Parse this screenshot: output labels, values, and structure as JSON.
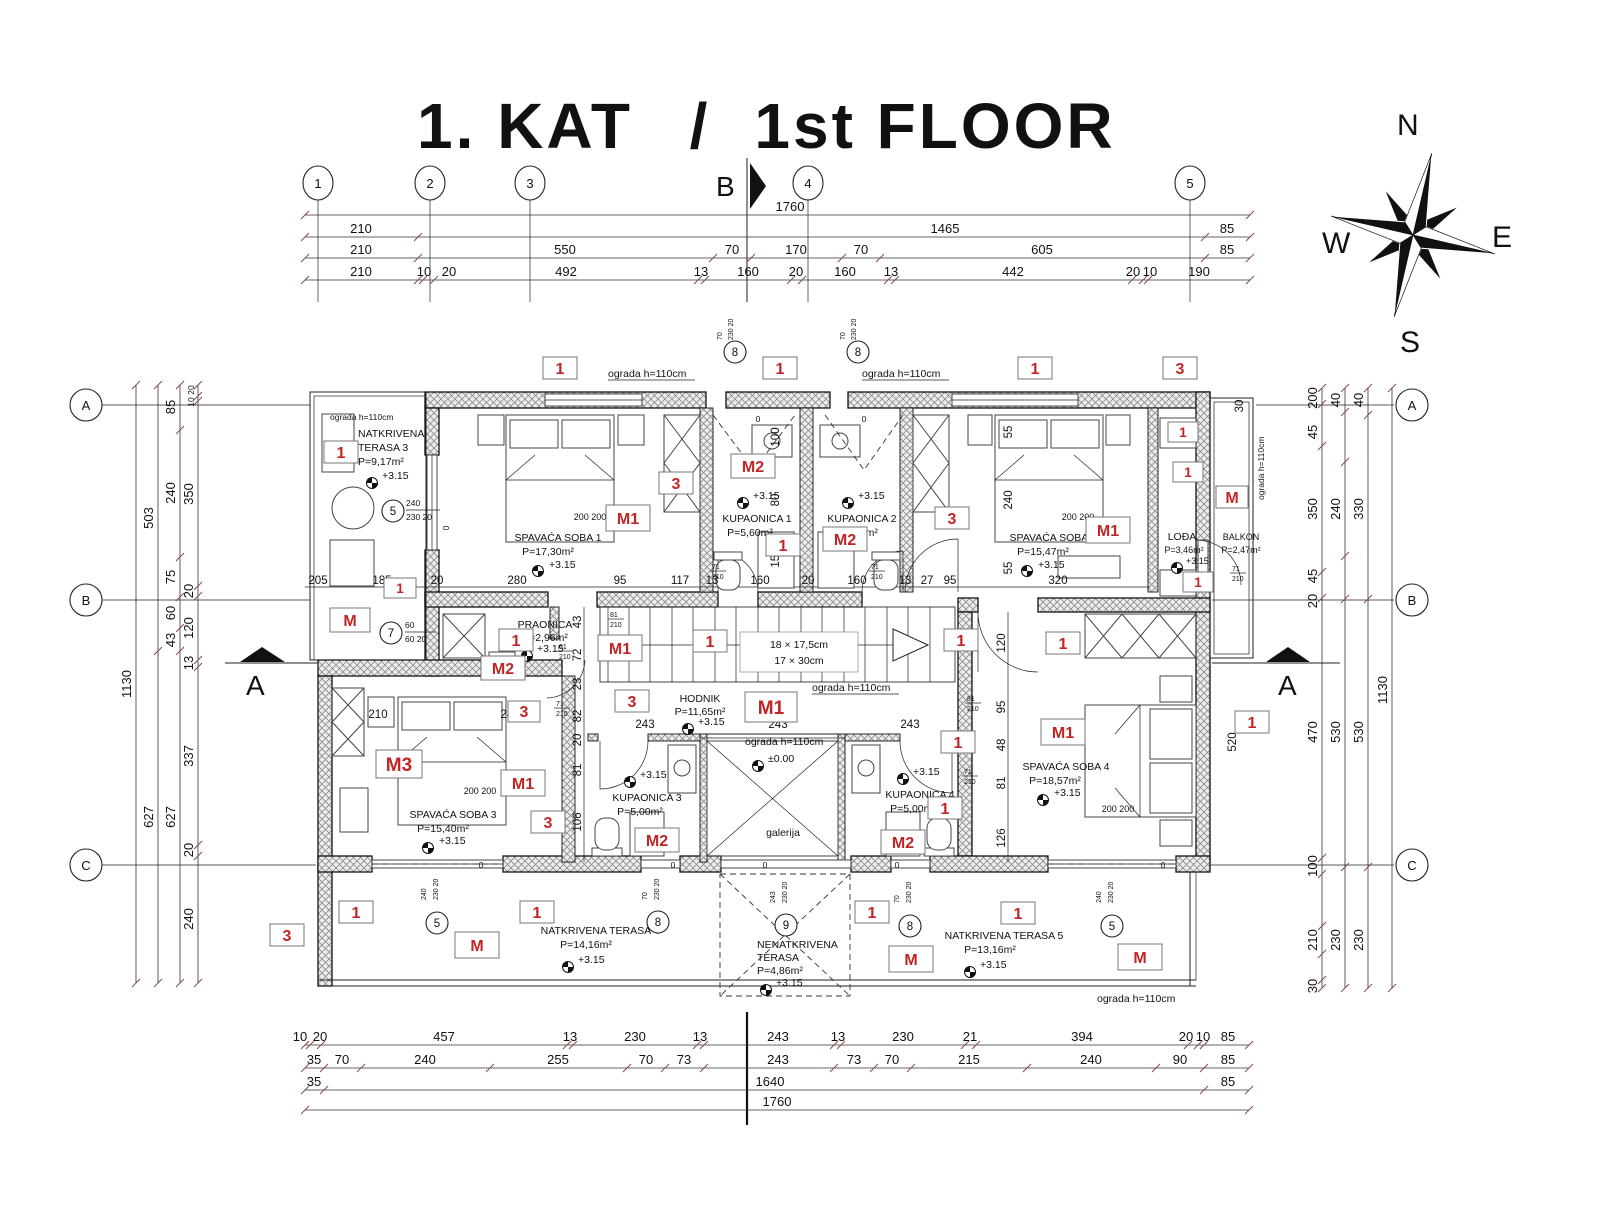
{
  "title": {
    "p1": "1. KAT",
    "p2": "/",
    "p3": "1st FLOOR"
  },
  "compass": {
    "n": "N",
    "e": "E",
    "s": "S",
    "w": "W"
  },
  "grid": {
    "c1": "1",
    "c2": "2",
    "c3": "3",
    "c4": "4",
    "c5": "5",
    "ra": "A",
    "rb": "B",
    "rc": "C"
  },
  "sections": {
    "a": "A",
    "b": "B"
  },
  "fence": "ograda h=110cm",
  "stairs": {
    "l1": "18 × 17,5cm",
    "l2": "17 × 30cm"
  },
  "levels": {
    "v": "+3.15",
    "z": "±0.00"
  },
  "marks": {
    "m": "M",
    "m1": "M1",
    "m2": "M2",
    "m3": "M3",
    "n1": "1",
    "n3": "3"
  },
  "circ": {
    "c5": "5",
    "c7": "7",
    "c8": "8",
    "c9": "9"
  },
  "cdims": {
    "a": "240",
    "b": "230  20",
    "c": "70",
    "d": "60",
    "e": "60  20",
    "f": "243"
  },
  "doors": {
    "d61": "61",
    "d71": "71",
    "d81": "81",
    "h": "210"
  },
  "rooms": {
    "t3": {
      "n1": "NATKRIVENA",
      "n2": "TERASA 3",
      "a": "P=9,17m²"
    },
    "s1": {
      "n": "SPAVAĆA SOBA 1",
      "a": "P=17,30m²",
      "bed": "200  200"
    },
    "k1": {
      "n": "KUPAONICA 1",
      "a": "P=5,60m²"
    },
    "k2": {
      "n": "KUPAONICA 2",
      "a": "P=5,60m²"
    },
    "s2": {
      "n": "SPAVAĆA SOBA 2",
      "a": "P=15,47m²",
      "bed": "200  200"
    },
    "lo": {
      "n": "LOĐA",
      "a": "P=3,46m²"
    },
    "ba": {
      "n": "BALKON",
      "a": "P=2,47m²"
    },
    "pr": {
      "n": "PRAONICA",
      "a": "P=2,96m²"
    },
    "ho": {
      "n": "HODNIK",
      "a": "P=11,65m²"
    },
    "s3": {
      "n": "SPAVAĆA SOBA 3",
      "a": "P=15,40m²",
      "bed": "200  200"
    },
    "k3": {
      "n": "KUPAONICA 3",
      "a": "P=5,00m²"
    },
    "k4": {
      "n": "KUPAONICA 4",
      "a": "P=5,00m²"
    },
    "s4": {
      "n": "SPAVAĆA SOBA 4",
      "a": "P=18,57m²",
      "bed": "200  200"
    },
    "t4": {
      "n": "NATKRIVENA TERASA 4",
      "a": "P=14,16m²"
    },
    "nt": {
      "n1": "NENATKRIVENA",
      "n2": "TERASA",
      "a": "P=4,86m²"
    },
    "t5": {
      "n": "NATKRIVENA TERASA 5",
      "a": "P=13,16m²"
    },
    "ga": {
      "n": "galerija"
    }
  },
  "dims_top": {
    "r1": [
      "1760"
    ],
    "r2": [
      "210",
      "1465",
      "85"
    ],
    "r3": [
      "210",
      "550",
      "70",
      "170",
      "70",
      "605",
      "85"
    ],
    "r4": [
      "210",
      "10",
      "20",
      "492",
      "13",
      "160",
      "20",
      "160",
      "13",
      "442",
      "20",
      "10",
      "190"
    ]
  },
  "dims_bottom": {
    "r1": [
      "10",
      "20",
      "457",
      "13",
      "230",
      "13",
      "243",
      "13",
      "230",
      "21",
      "394",
      "20",
      "10",
      "85"
    ],
    "r2": [
      "35",
      "70",
      "240",
      "255",
      "70",
      "73",
      "243",
      "73",
      "70",
      "215",
      "240",
      "90",
      "85"
    ],
    "r3": [
      "35",
      "1640",
      "85"
    ],
    "r4": [
      "1760"
    ]
  },
  "dims_left": {
    "c1": [
      "1130"
    ],
    "c2": [
      "503",
      "627"
    ],
    "c3": [
      "85",
      "240",
      "75",
      "60",
      "43",
      "627"
    ],
    "c4": [
      "20",
      "10",
      "350",
      "20",
      "120",
      "13",
      "337",
      "20",
      "240"
    ]
  },
  "dims_right": {
    "c1": [
      "200",
      "45",
      "350",
      "45",
      "20",
      "470",
      "100",
      "210",
      "30"
    ],
    "c2": [
      "40",
      "240",
      "530",
      "230"
    ],
    "c3": [
      "40",
      "330",
      "530",
      "230"
    ],
    "c4": [
      "1130"
    ]
  },
  "dims_mid": [
    "205",
    "185",
    "20",
    "280",
    "95",
    "117",
    "13",
    "160",
    "20",
    "160",
    "13",
    "27",
    "95",
    "320"
  ],
  "dims_v1": [
    "43",
    "72",
    "23",
    "82",
    "20",
    "81",
    "106"
  ],
  "dims_v2": [
    "120",
    "95",
    "48",
    "81",
    "126"
  ],
  "dims_v3": [
    "55",
    "240",
    "55"
  ],
  "dims_k1": [
    "100",
    "80",
    "150"
  ],
  "dims_s3": [
    "210",
    "247"
  ],
  "dims_c": [
    "243",
    "243",
    "243"
  ],
  "misc": {
    "m30": "30",
    "m520": "520",
    "m0": "0"
  }
}
